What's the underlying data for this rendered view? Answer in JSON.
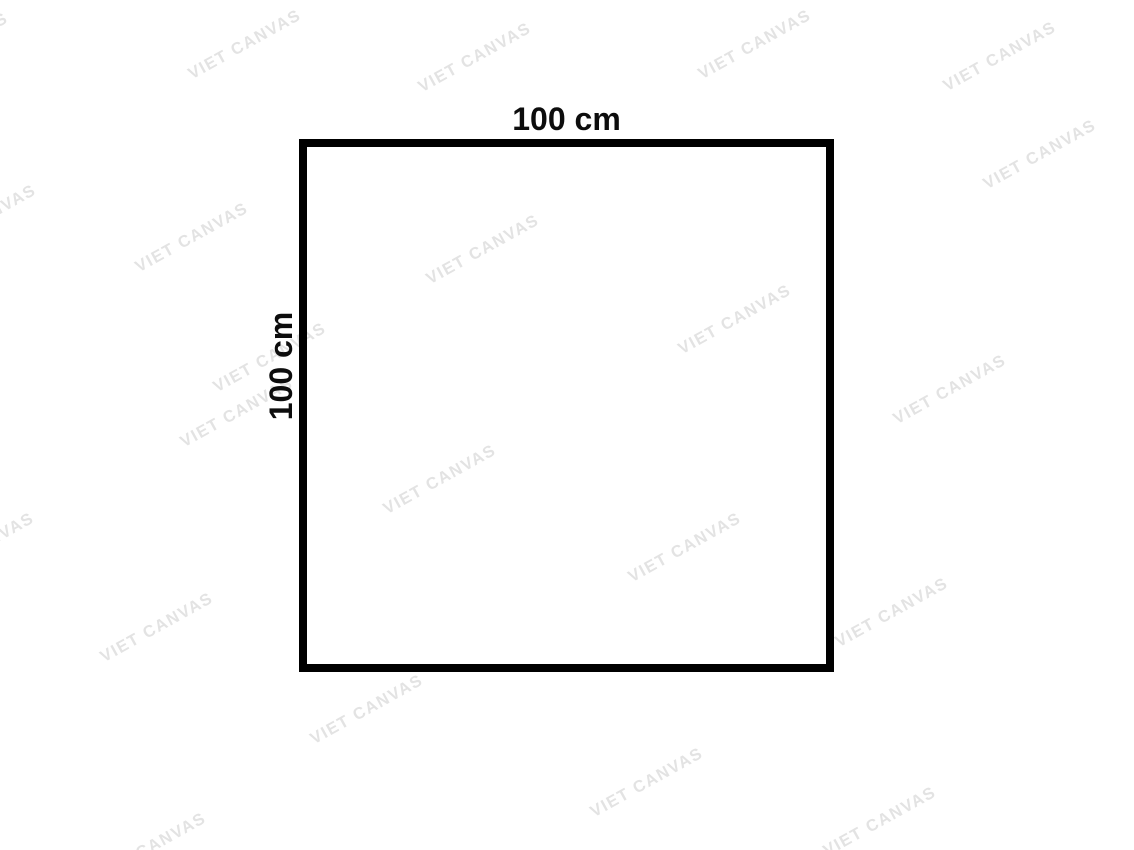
{
  "diagram": {
    "width_label": "100 cm",
    "height_label": "100 cm",
    "shape": "square-outline"
  },
  "watermark": {
    "text": "VIET CANVAS",
    "color": "#e3e3e3",
    "angle_deg": -29,
    "positions": [
      {
        "x": -48,
        "y": 48
      },
      {
        "x": 245,
        "y": 45
      },
      {
        "x": 475,
        "y": 58
      },
      {
        "x": 755,
        "y": 45
      },
      {
        "x": 1000,
        "y": 57
      },
      {
        "x": 1040,
        "y": 155
      },
      {
        "x": -20,
        "y": 220
      },
      {
        "x": 192,
        "y": 238
      },
      {
        "x": 483,
        "y": 250
      },
      {
        "x": 735,
        "y": 320
      },
      {
        "x": 270,
        "y": 358
      },
      {
        "x": 950,
        "y": 390
      },
      {
        "x": 237,
        "y": 413
      },
      {
        "x": 440,
        "y": 480
      },
      {
        "x": -22,
        "y": 548
      },
      {
        "x": 685,
        "y": 548
      },
      {
        "x": 892,
        "y": 613
      },
      {
        "x": 157,
        "y": 628
      },
      {
        "x": 367,
        "y": 710
      },
      {
        "x": 647,
        "y": 783
      },
      {
        "x": 880,
        "y": 822
      },
      {
        "x": 150,
        "y": 848
      }
    ]
  },
  "colors": {
    "background": "#ffffff",
    "outline": "#000000",
    "label_text": "#0d0d0d"
  }
}
